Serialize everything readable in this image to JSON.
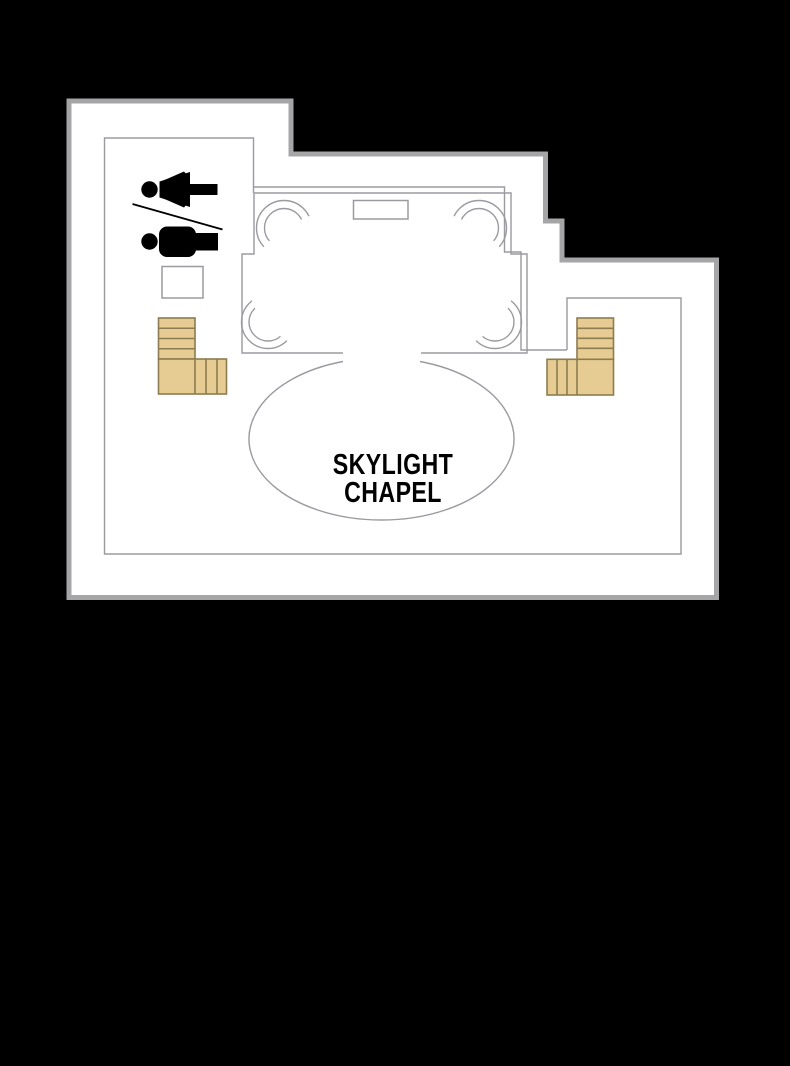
{
  "title": "SKYLIGHT CHAPEL",
  "labels": {
    "chapel_line1": "SKYLIGHT",
    "chapel_line2": "CHAPEL"
  },
  "icons": {
    "women_restroom_icon": "woman pictogram lying horizontal, head at left",
    "men_restroom_icon": "man pictogram lying horizontal, head at left",
    "restroom_divider": "diagonal slash line between the two figures",
    "stairs_left_icon": "L-shaped staircase with treads",
    "stairs_right_icon": "mirrored L-shaped staircase with treads",
    "skylight_oval": "quatrefoil skylight: oval with four ring lobes"
  },
  "colors": {
    "bg": "#000000",
    "floor": "#ffffff",
    "outline": "#a5a5a8",
    "thin_line": "#9a9aa0",
    "stair_fill": "#e6cc92",
    "stair_stroke": "#8d7c50",
    "ink": "#000000"
  }
}
